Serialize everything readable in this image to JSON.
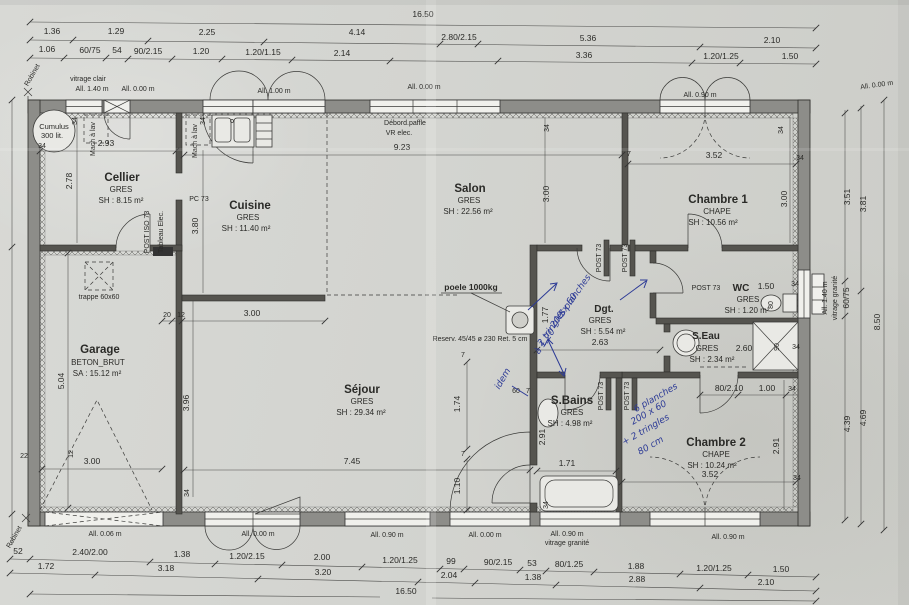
{
  "rooms": {
    "cellier": {
      "name": "Cellier",
      "finish": "GRES",
      "area": "SH : 8.15 m²"
    },
    "cuisine": {
      "name": "Cuisine",
      "finish": "GRES",
      "area": "SH : 11.40 m²"
    },
    "salon": {
      "name": "Salon",
      "finish": "GRES",
      "area": "SH : 22.56 m²"
    },
    "sejour": {
      "name": "Séjour",
      "finish": "GRES",
      "area": "SH : 29.34 m²"
    },
    "garage": {
      "name": "Garage",
      "finish": "BETON_BRUT",
      "area": "SA : 15.12 m²"
    },
    "chambre1": {
      "name": "Chambre 1",
      "finish": "CHAPE",
      "area": "SH : 10.56 m²"
    },
    "chambre2": {
      "name": "Chambre 2",
      "finish": "CHAPE",
      "area": "SH : 10.24 m²"
    },
    "dgt": {
      "name": "Dgt.",
      "finish": "GRES",
      "area": "SH : 5.54 m²"
    },
    "wc": {
      "name": "WC",
      "finish": "GRES",
      "area": "SH : 1.20 m²",
      "dim": "1.50"
    },
    "seau": {
      "name": "S.Eau",
      "finish": "GRES",
      "area": "SH : 2.34 m²",
      "dim": "2.60"
    },
    "sbains": {
      "name": "S.Bains",
      "finish": "GRES",
      "area": "SH : 4.98 m²"
    }
  },
  "labels": {
    "vitrage_clair": "vitrage clair",
    "all_140": "All. 1.40 m",
    "all_000": "All. 0.00 m",
    "all_100": "All. 1.00 m",
    "all_090": "All. 0.90 m",
    "all_006": "All. 0.06 m",
    "vitrage_granite": "vitrage granité",
    "debord": "Débord.paffle",
    "vr_elec": "VR elec.",
    "robinet": "Robinet"
  },
  "equipment": {
    "cumulus_line1": "Cumulus",
    "cumulus_line2": "300 lit.",
    "mach_a_lav": "Mach à lav",
    "pc": "PC 73",
    "post_iso": "POST ISO 73",
    "tableau_elec": "Tableau Elec.",
    "post": "POST 73",
    "trappe": "trappe 60x60",
    "poele": "poele 1000kg",
    "reserv": "Reserv. 45/45 ø 230  Ret. 5 cm"
  },
  "handwritten": {
    "n1_l1": "5 planches",
    "n1_l2": "200 x 60",
    "n1_l3": "2 tringles",
    "n1_l4": "à 1,20",
    "idem": "idem",
    "n2_l1": "6 planches",
    "n2_l2": "200 x 60",
    "n2_l3": "+ 2 tringles",
    "n2_l4": "80 cm"
  },
  "dims": {
    "total": "16.50",
    "top1": [
      "1.36",
      "1.29",
      "2.25",
      "4.14",
      "2.80/2.15",
      "5.36",
      "2.10"
    ],
    "top2": [
      "1.06",
      "60/75",
      "54",
      "90/2.15",
      "1.20",
      "1.20/1.15",
      "2.14",
      "3.36",
      "1.20/1.25",
      "1.50"
    ],
    "bottom1": [
      "52",
      "2.40/2.00",
      "1.38",
      "1.20/2.15",
      "2.00",
      "1.20/1.25",
      "99",
      "90/2.15",
      "53",
      "80/1.25",
      "1.88",
      "1.20/1.25",
      "1.50"
    ],
    "bottom2": [
      "1.72",
      "3.18",
      "3.20",
      "2.04",
      "1.38",
      "2.88",
      "2.10"
    ],
    "right1": [
      "3.51",
      "60/75",
      "4.39"
    ],
    "right2": [
      "3.81",
      "4.69"
    ],
    "right_total": "8.50",
    "i": {
      "cellier_w": "2.93",
      "cellier_h": "2.78",
      "cuisine_h": "3.80",
      "salon_w": "9.23",
      "salon_h": "3.00",
      "ch1_w": "3.52",
      "ch1_h": "3.00",
      "stub20": "20",
      "stub12": "12",
      "sejour_top": "3.00",
      "garage_h": "5.04",
      "garage_inner": "3.96",
      "garage_door": "3.00",
      "d12": "12",
      "d22": "22",
      "sejour_w": "7.45",
      "d174": "1.74",
      "d110": "1.10",
      "d60": "60",
      "d7": "7",
      "dgt_h": "1.77",
      "dgt_w": "2.63",
      "sbains_w": "1.71",
      "sbains_h": "2.91",
      "ch2_w": "3.52",
      "ch2_h": "2.91",
      "ch2_door": "80/2.10",
      "d100": "1.00",
      "wc_door": "80",
      "seau_door": "90",
      "t34": "34"
    }
  }
}
